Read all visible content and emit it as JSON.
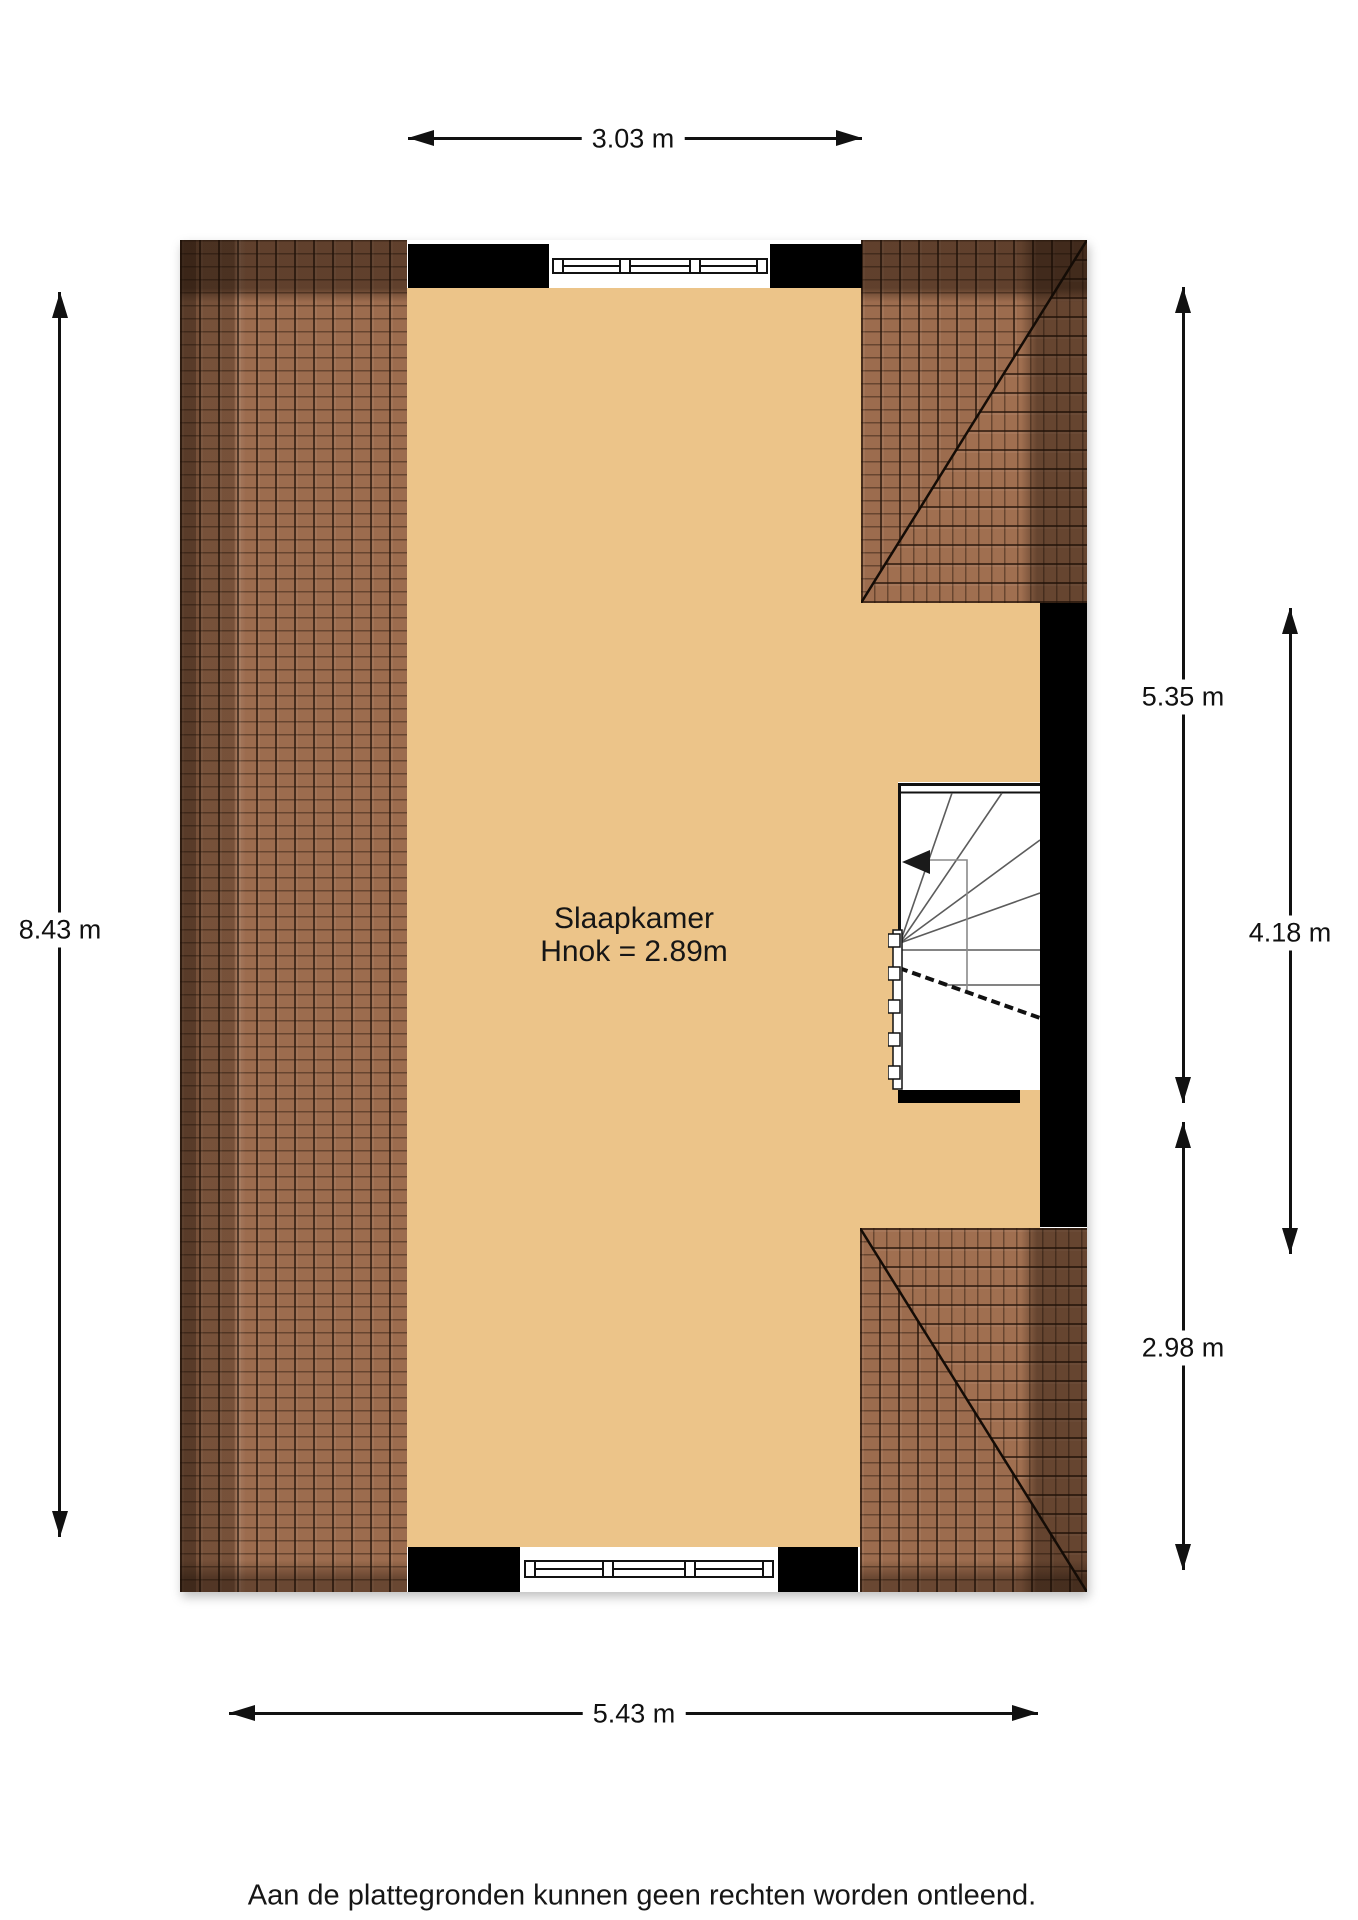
{
  "room": {
    "name": "Slaapkamer",
    "height_label": "Hnok = 2.89m"
  },
  "dimensions": {
    "top": "3.03 m",
    "left": "8.43 m",
    "bottom": "5.43 m",
    "right_full": "5.35 m",
    "right_middle": "4.18 m",
    "right_lower": "2.98 m"
  },
  "footer": {
    "disclaimer": "Aan de plattegronden kunnen geen rechten worden ontleend."
  },
  "colors": {
    "floor": "#ecc489",
    "wall": "#000000",
    "roof_tile": "#9c6c4e",
    "roof_line": "#26150a",
    "dimension": "#111111"
  }
}
